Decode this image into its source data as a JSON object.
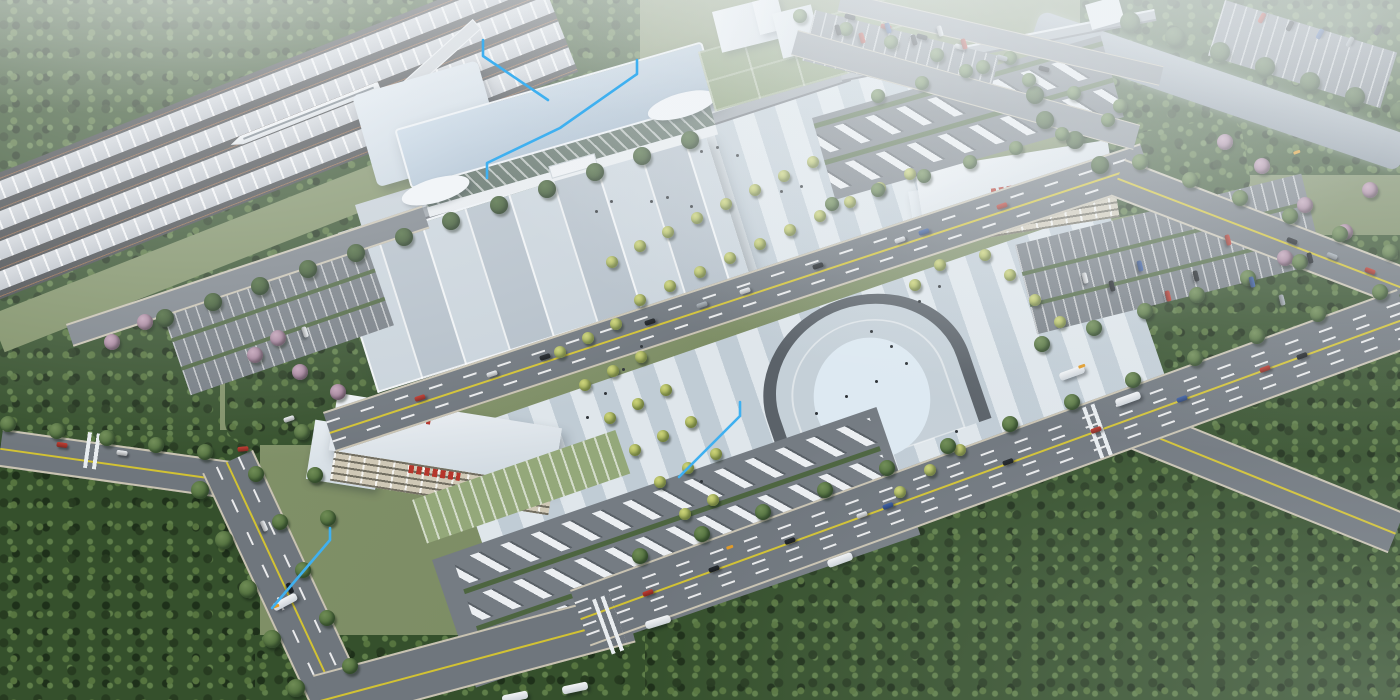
{
  "scene": {
    "title": "Aerial 3D architectural rendering of a high-speed railway station complex with forecourt plaza, bus terminals, parking lots, roads, river and forest",
    "landmarks": {
      "railway_corridor": "multi-track railway with platform canopies and a white high-speed train, upper left",
      "station_terminal": "long terminal building with pale blue roof and glazed facade",
      "forecourt_canopy": "large striped canopy over the drop-off forecourt",
      "elevated_walkway": "elevated corridor running along the station front",
      "plaza": "pedestrian plaza with ornamental trees, people and a horseshoe-shaped sunken feature",
      "bus_terminal_left": "white bus terminal building with red signage, lower left",
      "bus_terminal_right": "white bus terminal building with red signage, middle right",
      "bus_depots": "two depots with rows of parked white buses",
      "parking_lots": "five surface car parks with parked cars",
      "river": "grey-blue river crossing the upper right corner",
      "forest": "dense tree cover on the left, top and lower right"
    },
    "palette": {
      "grass": "#7f9066",
      "forest": "#35502c",
      "road": "#6f767d",
      "curb": "#c9c3b2",
      "yellow_line": "#d2c233",
      "plaza": "#ccd7df",
      "canopy_a": "#c9d3db",
      "canopy_b": "#b4bfc9",
      "station_roof": "#b7cadc",
      "glass": "#57695f",
      "river": "#97a2ac",
      "hedge": "#4d6540",
      "red_sign": "#b5362b",
      "annotation_blue": "#3fb0f0",
      "bus_white": "#eef1f4"
    },
    "car_colors": {
      "red": "#c23b30",
      "blue": "#3a5ea6",
      "black": "#22272c",
      "white": "#eef1f4",
      "silver": "#aab3ba"
    }
  },
  "annotations": {
    "color": "#3fb0f0",
    "lines": [
      [
        [
          483,
          40
        ],
        [
          483,
          56
        ],
        [
          548,
          100
        ]
      ],
      [
        [
          637,
          60
        ],
        [
          637,
          74
        ],
        [
          560,
          128
        ],
        [
          487,
          163
        ],
        [
          487,
          178
        ]
      ],
      [
        [
          740,
          402
        ],
        [
          740,
          416
        ],
        [
          679,
          477
        ]
      ],
      [
        [
          330,
          528
        ],
        [
          330,
          540
        ],
        [
          272,
          608
        ]
      ]
    ]
  },
  "vehicles": {
    "cars": [
      [
        420,
        398,
        -18,
        "red"
      ],
      [
        492,
        374,
        -18,
        "white"
      ],
      [
        545,
        357,
        -18,
        "black"
      ],
      [
        650,
        322,
        -18,
        "black"
      ],
      [
        702,
        305,
        -18,
        "silver"
      ],
      [
        745,
        291,
        -18,
        "white"
      ],
      [
        818,
        266,
        -18,
        "black"
      ],
      [
        900,
        240,
        -18,
        "white"
      ],
      [
        924,
        232,
        -18,
        "blue"
      ],
      [
        1002,
        206,
        -18,
        "red"
      ],
      [
        648,
        593,
        -20,
        "red"
      ],
      [
        714,
        569,
        -20,
        "black"
      ],
      [
        790,
        541,
        -20,
        "black"
      ],
      [
        862,
        515,
        -20,
        "white"
      ],
      [
        888,
        506,
        -20,
        "blue"
      ],
      [
        1008,
        462,
        -20,
        "black"
      ],
      [
        1096,
        430,
        -20,
        "red"
      ],
      [
        1182,
        399,
        -20,
        "blue"
      ],
      [
        1265,
        369,
        -20,
        "red"
      ],
      [
        1302,
        356,
        -20,
        "black"
      ],
      [
        1292,
        241,
        21,
        "black"
      ],
      [
        1332,
        256,
        21,
        "silver"
      ],
      [
        1370,
        271,
        21,
        "red"
      ],
      [
        850,
        17,
        15,
        "black"
      ],
      [
        886,
        27,
        15,
        "red"
      ],
      [
        922,
        37,
        15,
        "black"
      ],
      [
        960,
        47,
        15,
        "white"
      ],
      [
        1002,
        58,
        15,
        "silver"
      ],
      [
        1044,
        69,
        15,
        "black"
      ],
      [
        264,
        526,
        66,
        "white"
      ],
      [
        290,
        588,
        66,
        "black"
      ],
      [
        62,
        445,
        8,
        "red"
      ],
      [
        122,
        453,
        8,
        "white"
      ],
      [
        243,
        449,
        -5,
        "red"
      ],
      [
        289,
        419,
        -18,
        "white"
      ],
      [
        1085,
        278,
        76,
        "white"
      ],
      [
        1112,
        286,
        76,
        "black"
      ],
      [
        1140,
        266,
        76,
        "blue"
      ],
      [
        1168,
        296,
        76,
        "red"
      ],
      [
        1196,
        276,
        76,
        "black"
      ],
      [
        1228,
        240,
        76,
        "red"
      ],
      [
        1252,
        282,
        76,
        "blue"
      ],
      [
        1282,
        300,
        76,
        "silver"
      ],
      [
        1310,
        258,
        76,
        "black"
      ],
      [
        838,
        30,
        74,
        "black"
      ],
      [
        862,
        38,
        74,
        "red"
      ],
      [
        888,
        28,
        74,
        "blue"
      ],
      [
        914,
        40,
        74,
        "black"
      ],
      [
        940,
        31,
        74,
        "white"
      ],
      [
        964,
        44,
        74,
        "red"
      ],
      [
        1262,
        18,
        -62,
        "red"
      ],
      [
        1290,
        26,
        -62,
        "black"
      ],
      [
        1320,
        34,
        -62,
        "blue"
      ],
      [
        1350,
        42,
        -62,
        "silver"
      ],
      [
        1378,
        30,
        -62,
        "black"
      ],
      [
        305,
        332,
        72,
        "white"
      ]
    ],
    "buses": [
      [
        285,
        602,
        -28
      ],
      [
        658,
        622,
        -17
      ],
      [
        840,
        560,
        -20
      ],
      [
        1128,
        399,
        -20
      ],
      [
        1072,
        373,
        -20
      ],
      [
        575,
        688,
        -12
      ],
      [
        515,
        697,
        -12
      ]
    ]
  },
  "trees": {
    "singles": [
      [
        612,
        262
      ],
      [
        640,
        246
      ],
      [
        668,
        232
      ],
      [
        697,
        218
      ],
      [
        726,
        204
      ],
      [
        755,
        190
      ],
      [
        784,
        176
      ],
      [
        813,
        162
      ],
      [
        640,
        300
      ],
      [
        670,
        286
      ],
      [
        700,
        272
      ],
      [
        730,
        258
      ],
      [
        760,
        244
      ],
      [
        790,
        230
      ],
      [
        820,
        216
      ],
      [
        850,
        202
      ],
      [
        880,
        188
      ],
      [
        910,
        174
      ],
      [
        560,
        352
      ],
      [
        588,
        338
      ],
      [
        616,
        324
      ],
      [
        585,
        385
      ],
      [
        613,
        371
      ],
      [
        641,
        357
      ],
      [
        610,
        418
      ],
      [
        638,
        404
      ],
      [
        666,
        390
      ],
      [
        635,
        450
      ],
      [
        663,
        436
      ],
      [
        691,
        422
      ],
      [
        660,
        482
      ],
      [
        688,
        468
      ],
      [
        716,
        454
      ],
      [
        685,
        514
      ],
      [
        713,
        500
      ],
      [
        1035,
        300
      ],
      [
        1060,
        322
      ],
      [
        1010,
        275
      ],
      [
        985,
        255
      ],
      [
        930,
        470
      ],
      [
        960,
        450
      ],
      [
        900,
        492
      ],
      [
        915,
        285
      ],
      [
        940,
        265
      ]
    ],
    "pinks": [
      [
        255,
        355
      ],
      [
        300,
        372
      ],
      [
        338,
        392
      ],
      [
        278,
        338
      ],
      [
        145,
        322
      ],
      [
        112,
        342
      ],
      [
        1305,
        205
      ],
      [
        1345,
        232
      ],
      [
        1285,
        258
      ],
      [
        1370,
        190
      ],
      [
        1225,
        142
      ],
      [
        1262,
        166
      ]
    ],
    "darks": [
      [
        1045,
        120
      ],
      [
        1075,
        140
      ],
      [
        1100,
        165
      ],
      [
        1035,
        95
      ]
    ],
    "rows": [
      {
        "from": [
          640,
          556
        ],
        "to": [
          1380,
          292
        ],
        "n": 13,
        "r": 8,
        "type": "street"
      },
      {
        "from": [
          165,
          318
        ],
        "to": [
          690,
          140
        ],
        "n": 12,
        "r": 9,
        "type": "dark"
      },
      {
        "from": [
          256,
          474
        ],
        "to": [
          350,
          666
        ],
        "n": 5,
        "r": 8,
        "type": "street"
      },
      {
        "from": [
          200,
          490
        ],
        "to": [
          296,
          688
        ],
        "n": 5,
        "r": 9,
        "type": "street"
      },
      {
        "from": [
          8,
          424
        ],
        "to": [
          205,
          452
        ],
        "n": 5,
        "r": 8,
        "type": "street"
      },
      {
        "from": [
          1140,
          162
        ],
        "to": [
          1390,
          252
        ],
        "n": 6,
        "r": 8,
        "type": "street"
      },
      {
        "from": [
          1042,
          344
        ],
        "to": [
          1300,
          262
        ],
        "n": 6,
        "r": 8,
        "type": "street"
      },
      {
        "from": [
          800,
          16
        ],
        "to": [
          1120,
          106
        ],
        "n": 8,
        "r": 7,
        "type": "street"
      },
      {
        "from": [
          832,
          204
        ],
        "to": [
          1108,
          120
        ],
        "n": 7,
        "r": 7,
        "type": "street"
      },
      {
        "from": [
          1130,
          22
        ],
        "to": [
          1400,
          112
        ],
        "n": 7,
        "r": 10,
        "type": "dark"
      },
      {
        "from": [
          302,
          432
        ],
        "to": [
          328,
          518
        ],
        "n": 3,
        "r": 8,
        "type": "street"
      },
      {
        "from": [
          878,
          96
        ],
        "to": [
          1010,
          58
        ],
        "n": 4,
        "r": 7,
        "type": "street"
      }
    ]
  },
  "people": [
    [
      700,
      150
    ],
    [
      716,
      146
    ],
    [
      736,
      154
    ],
    [
      650,
      200
    ],
    [
      666,
      196
    ],
    [
      690,
      205
    ],
    [
      780,
      190
    ],
    [
      800,
      185
    ],
    [
      640,
      345
    ],
    [
      622,
      368
    ],
    [
      604,
      392
    ],
    [
      586,
      416
    ],
    [
      870,
      330
    ],
    [
      890,
      345
    ],
    [
      905,
      362
    ],
    [
      875,
      380
    ],
    [
      845,
      395
    ],
    [
      815,
      412
    ],
    [
      918,
      300
    ],
    [
      938,
      285
    ],
    [
      955,
      430
    ],
    [
      700,
      480
    ],
    [
      610,
      200
    ],
    [
      595,
      210
    ]
  ],
  "gates": [
    [
      272,
      606
    ],
    [
      726,
      547
    ],
    [
      1078,
      366
    ],
    [
      1293,
      152
    ]
  ]
}
